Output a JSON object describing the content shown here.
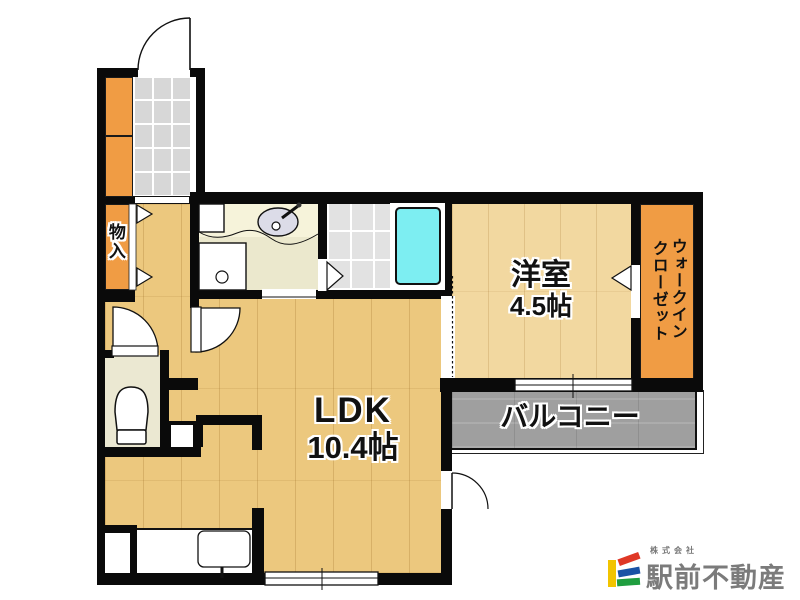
{
  "floorplan": {
    "rooms": {
      "storage": {
        "label": "物入"
      },
      "western_room": {
        "label": "洋室",
        "size": "4.5帖"
      },
      "walk_in_closet": {
        "label_column_right": "ウォークイン",
        "label_column_left": "クローゼット"
      },
      "ldk": {
        "label": "LDK",
        "size": "10.4帖"
      },
      "balcony": {
        "label": "バルコニー"
      }
    },
    "colors": {
      "wall": "#0a0a0a",
      "wood_floor": "#ecc87e",
      "western_room_floor": "#f2d8a0",
      "closet_orange": "#f09c44",
      "washroom_cream": "#ebe8cd",
      "bath_tile": "#e2e2e2",
      "bathtub_cyan": "#7deef2",
      "genkan_tile": "#d7d7d7",
      "balcony_gray": "#9f9f9f"
    }
  },
  "logo": {
    "company_prefix": "株式会社",
    "company_name": "駅前不動産",
    "mark": {
      "yellow": "#f2c400",
      "red": "#df3826",
      "blue": "#1a52a5",
      "green": "#1f9e3f"
    }
  }
}
